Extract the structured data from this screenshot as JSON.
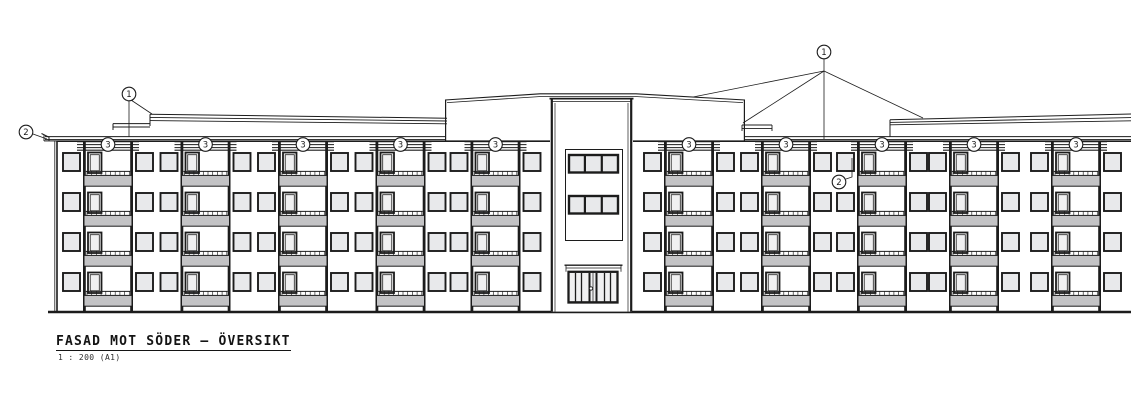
{
  "drawing": {
    "title": "FASAD MOT SÖDER – ÖVERSIKT",
    "scale": "1 : 200 (A1)"
  },
  "markers": {
    "roof_left": "1",
    "roof_right": "1",
    "gutter_left": "2",
    "window_right": "2",
    "balconies": [
      "3",
      "3",
      "3",
      "3",
      "3",
      "3",
      "3",
      "3",
      "3",
      "3"
    ]
  },
  "colors": {
    "line": "#1c1c1c",
    "glass": "#e8e9eb",
    "panel": "#c3c3c5",
    "door_pane": "#f0f0f1",
    "paper": "#ffffff"
  }
}
